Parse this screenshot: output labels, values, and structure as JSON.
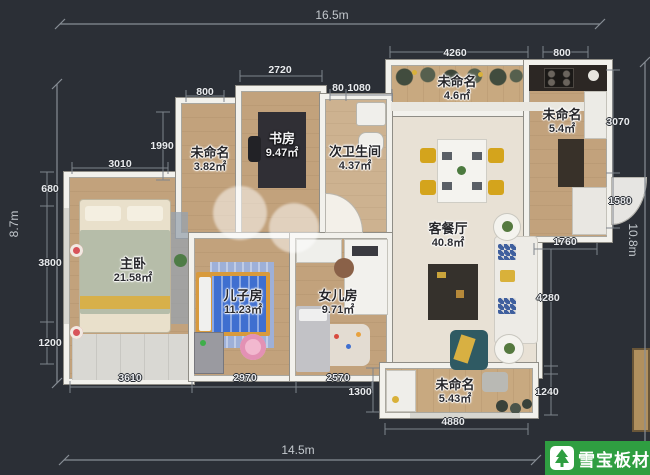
{
  "overall": {
    "top": "16.5m",
    "left": "8.7m",
    "right": "10.8m",
    "bottom": "14.5m"
  },
  "rooms": [
    {
      "id": "noname-382",
      "name": "未命名",
      "area": "3.82㎡"
    },
    {
      "id": "study",
      "name": "书房",
      "area": "9.47㎡"
    },
    {
      "id": "second-bath",
      "name": "次卫生间",
      "area": "4.37㎡"
    },
    {
      "id": "balcony-top",
      "name": "未命名",
      "area": "4.6㎡"
    },
    {
      "id": "kitchen",
      "name": "未命名",
      "area": "5.4㎡"
    },
    {
      "id": "living-dining",
      "name": "客餐厅",
      "area": "40.8㎡"
    },
    {
      "id": "master-bedroom",
      "name": "主卧",
      "area": "21.58㎡"
    },
    {
      "id": "son-room",
      "name": "儿子房",
      "area": "11.23㎡"
    },
    {
      "id": "daughter-room",
      "name": "女儿房",
      "area": "9.71㎡"
    },
    {
      "id": "balcony-bottom",
      "name": "未命名",
      "area": "5.43㎡"
    }
  ],
  "dims": [
    "2720",
    "800",
    "1990",
    "3010",
    "680",
    "3800",
    "1200",
    "80",
    "1080",
    "4260",
    "800",
    "3070",
    "1580",
    "1760",
    "4280",
    "1240",
    "3610",
    "2970",
    "2570",
    "1300",
    "4880"
  ],
  "logo": {
    "brand": "雪宝板材"
  },
  "colors": {
    "logo_green": "#2f9e41",
    "background": "#2b2f36",
    "wall": "#f2f1ec",
    "wood_floor": "#c2a27c",
    "living_floor": "#e8e1d5"
  }
}
